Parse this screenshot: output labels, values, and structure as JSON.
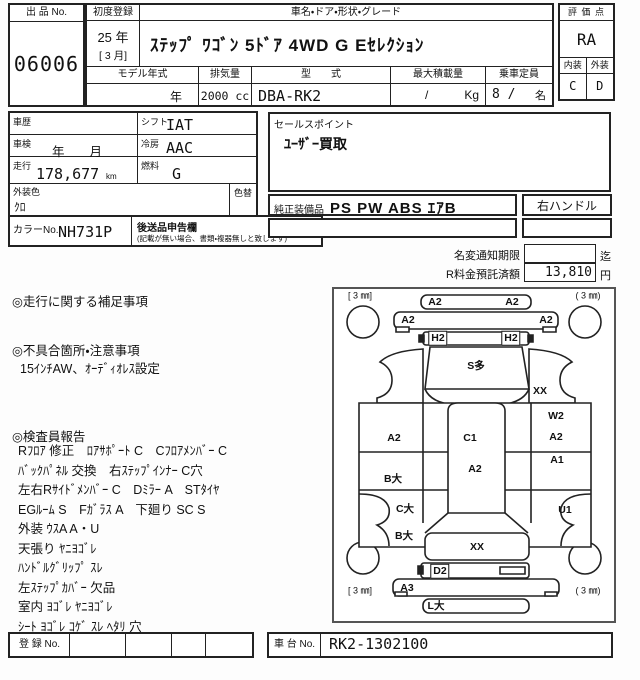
{
  "sheet": {
    "exhibit": {
      "label": "出 品 No.",
      "value": "06006"
    },
    "first_reg": {
      "label": "初度登録",
      "year": "25 年",
      "month": "[ 3 月]"
    },
    "name": {
      "label": "車名・ドア・形状・グレード",
      "value": "ｽﾃｯﾌﾟ ﾜｺﾞﾝ 5ﾄﾞｱ 4WD G Eｾﾚｸｼｮﾝ"
    },
    "model_year": {
      "label": "モデル年式",
      "value": "年"
    },
    "displacement": {
      "label": "排気量",
      "value": "2000 cc"
    },
    "model_code": {
      "label": "型　　式",
      "value": "DBA-RK2"
    },
    "max_load": {
      "label": "最大積載量",
      "slash": "/",
      "unit": "Kg"
    },
    "capacity": {
      "label": "乗車定員",
      "value": "8 /",
      "unit": "名"
    },
    "grade": {
      "label": "評 価 点",
      "score": "RA",
      "interior_label": "内装",
      "exterior_label": "外装",
      "interior": "C",
      "exterior": "D"
    }
  },
  "details": {
    "history": {
      "label": "車歴"
    },
    "shift": {
      "label": "シフト",
      "value": "IAT"
    },
    "inspection": {
      "label": "車検",
      "value": "年　　月"
    },
    "aircon": {
      "label": "冷房",
      "value": "AAC"
    },
    "mileage": {
      "label": "走行",
      "value": "178,677",
      "unit": "km"
    },
    "fuel": {
      "label": "燃料",
      "value": "G"
    },
    "ext_color": {
      "label": "外装色",
      "value": "ｸﾛ"
    },
    "color_change": {
      "label": "色替"
    },
    "color_no": {
      "label": "カラーNo.",
      "value": "NH731P"
    },
    "late_items": {
      "label": "後送品申告欄",
      "note": "(記載が無い場合、書類・複器無しと致します)"
    },
    "sales_point": {
      "label": "セールスポイント",
      "value": "ﾕｰｻﾞｰ買取"
    },
    "equipment": {
      "label": "純正装備品",
      "value": "PS PW ABS ｴｱB"
    },
    "handle": {
      "value": "右ハンドル"
    },
    "name_change": {
      "label": "名変通知期限",
      "value": "",
      "suffix": "迄"
    },
    "recycle_fee": {
      "label": "R料金預託済額",
      "value": "13,810",
      "unit": "円"
    }
  },
  "notes": {
    "driving_title": "◎走行に関する補足事項",
    "defect_title": "◎不具合箇所・注意事項",
    "defect_line": "15ｲﾝﾁAW、ｵｰﾃﾞｨｵﾚｽ設定",
    "inspector_title": "◎検査員報告",
    "inspector_lines": [
      "Rﾌﾛｱ 修正　ﾛｱｻﾎﾟｰﾄ C　Cﾌﾛｱﾒﾝﾊﾞｰ C",
      "ﾊﾞｯｸﾊﾟﾈﾙ 交換　右ｽﾃｯﾌﾟｲﾝﾅｰ C穴",
      "左右Rｻｲﾄﾞﾒﾝﾊﾞｰ C　Dﾐﾗｰ A　STﾀｲﾔ",
      "EGﾙｰﾑ S　Fｶﾞﾗｽ A　下廻り SC S",
      "外装 ｳｽA A・U",
      "天張り ﾔﾆﾖｺﾞﾚ",
      "ﾊﾝﾄﾞﾙｸﾞﾘｯﾌﾟ ｽﾚ",
      "左ｽﾃｯﾌﾟｶﾊﾞｰ 欠品",
      "室内 ﾖｺﾞﾚ ﾔﾆﾖｺﾞﾚ",
      "ｼｰﾄ ﾖｺﾞﾚ ｺｹﾞ ｽﾚ ﾍﾀﾘ 穴"
    ]
  },
  "diagram": {
    "tires": {
      "front_left": "[ 3 ㎜]",
      "front_right": "( 3 ㎜)",
      "rear_left": "[ 3 ㎜]",
      "rear_right": "( 3 ㎜)"
    },
    "labels": [
      {
        "t": "A2",
        "x": 101,
        "y": 13
      },
      {
        "t": "A2",
        "x": 178,
        "y": 13
      },
      {
        "t": "A2",
        "x": 74,
        "y": 31
      },
      {
        "t": "A2",
        "x": 212,
        "y": 31
      },
      {
        "t": "H2",
        "x": 104,
        "y": 49,
        "boxed": true
      },
      {
        "t": "H2",
        "x": 177,
        "y": 49,
        "boxed": true
      },
      {
        "t": "S多",
        "x": 142,
        "y": 77
      },
      {
        "t": "XX",
        "x": 206,
        "y": 102
      },
      {
        "t": "A2",
        "x": 60,
        "y": 149
      },
      {
        "t": "C1",
        "x": 136,
        "y": 149
      },
      {
        "t": "A2",
        "x": 141,
        "y": 180
      },
      {
        "t": "W2",
        "x": 222,
        "y": 127
      },
      {
        "t": "A2",
        "x": 222,
        "y": 148
      },
      {
        "t": "A1",
        "x": 223,
        "y": 171
      },
      {
        "t": "B大",
        "x": 59,
        "y": 190
      },
      {
        "t": "C大",
        "x": 71,
        "y": 220
      },
      {
        "t": "B大",
        "x": 70,
        "y": 247
      },
      {
        "t": "U1",
        "x": 231,
        "y": 221
      },
      {
        "t": "XX",
        "x": 143,
        "y": 258
      },
      {
        "t": "D2",
        "x": 106,
        "y": 282,
        "boxed": true
      },
      {
        "t": "A3",
        "x": 73,
        "y": 299
      },
      {
        "t": "L大",
        "x": 102,
        "y": 317
      }
    ]
  },
  "footer": {
    "registration": {
      "label": "登 録 No."
    },
    "chassis": {
      "label": "車 台 No.",
      "value": "RK2-1302100"
    }
  }
}
